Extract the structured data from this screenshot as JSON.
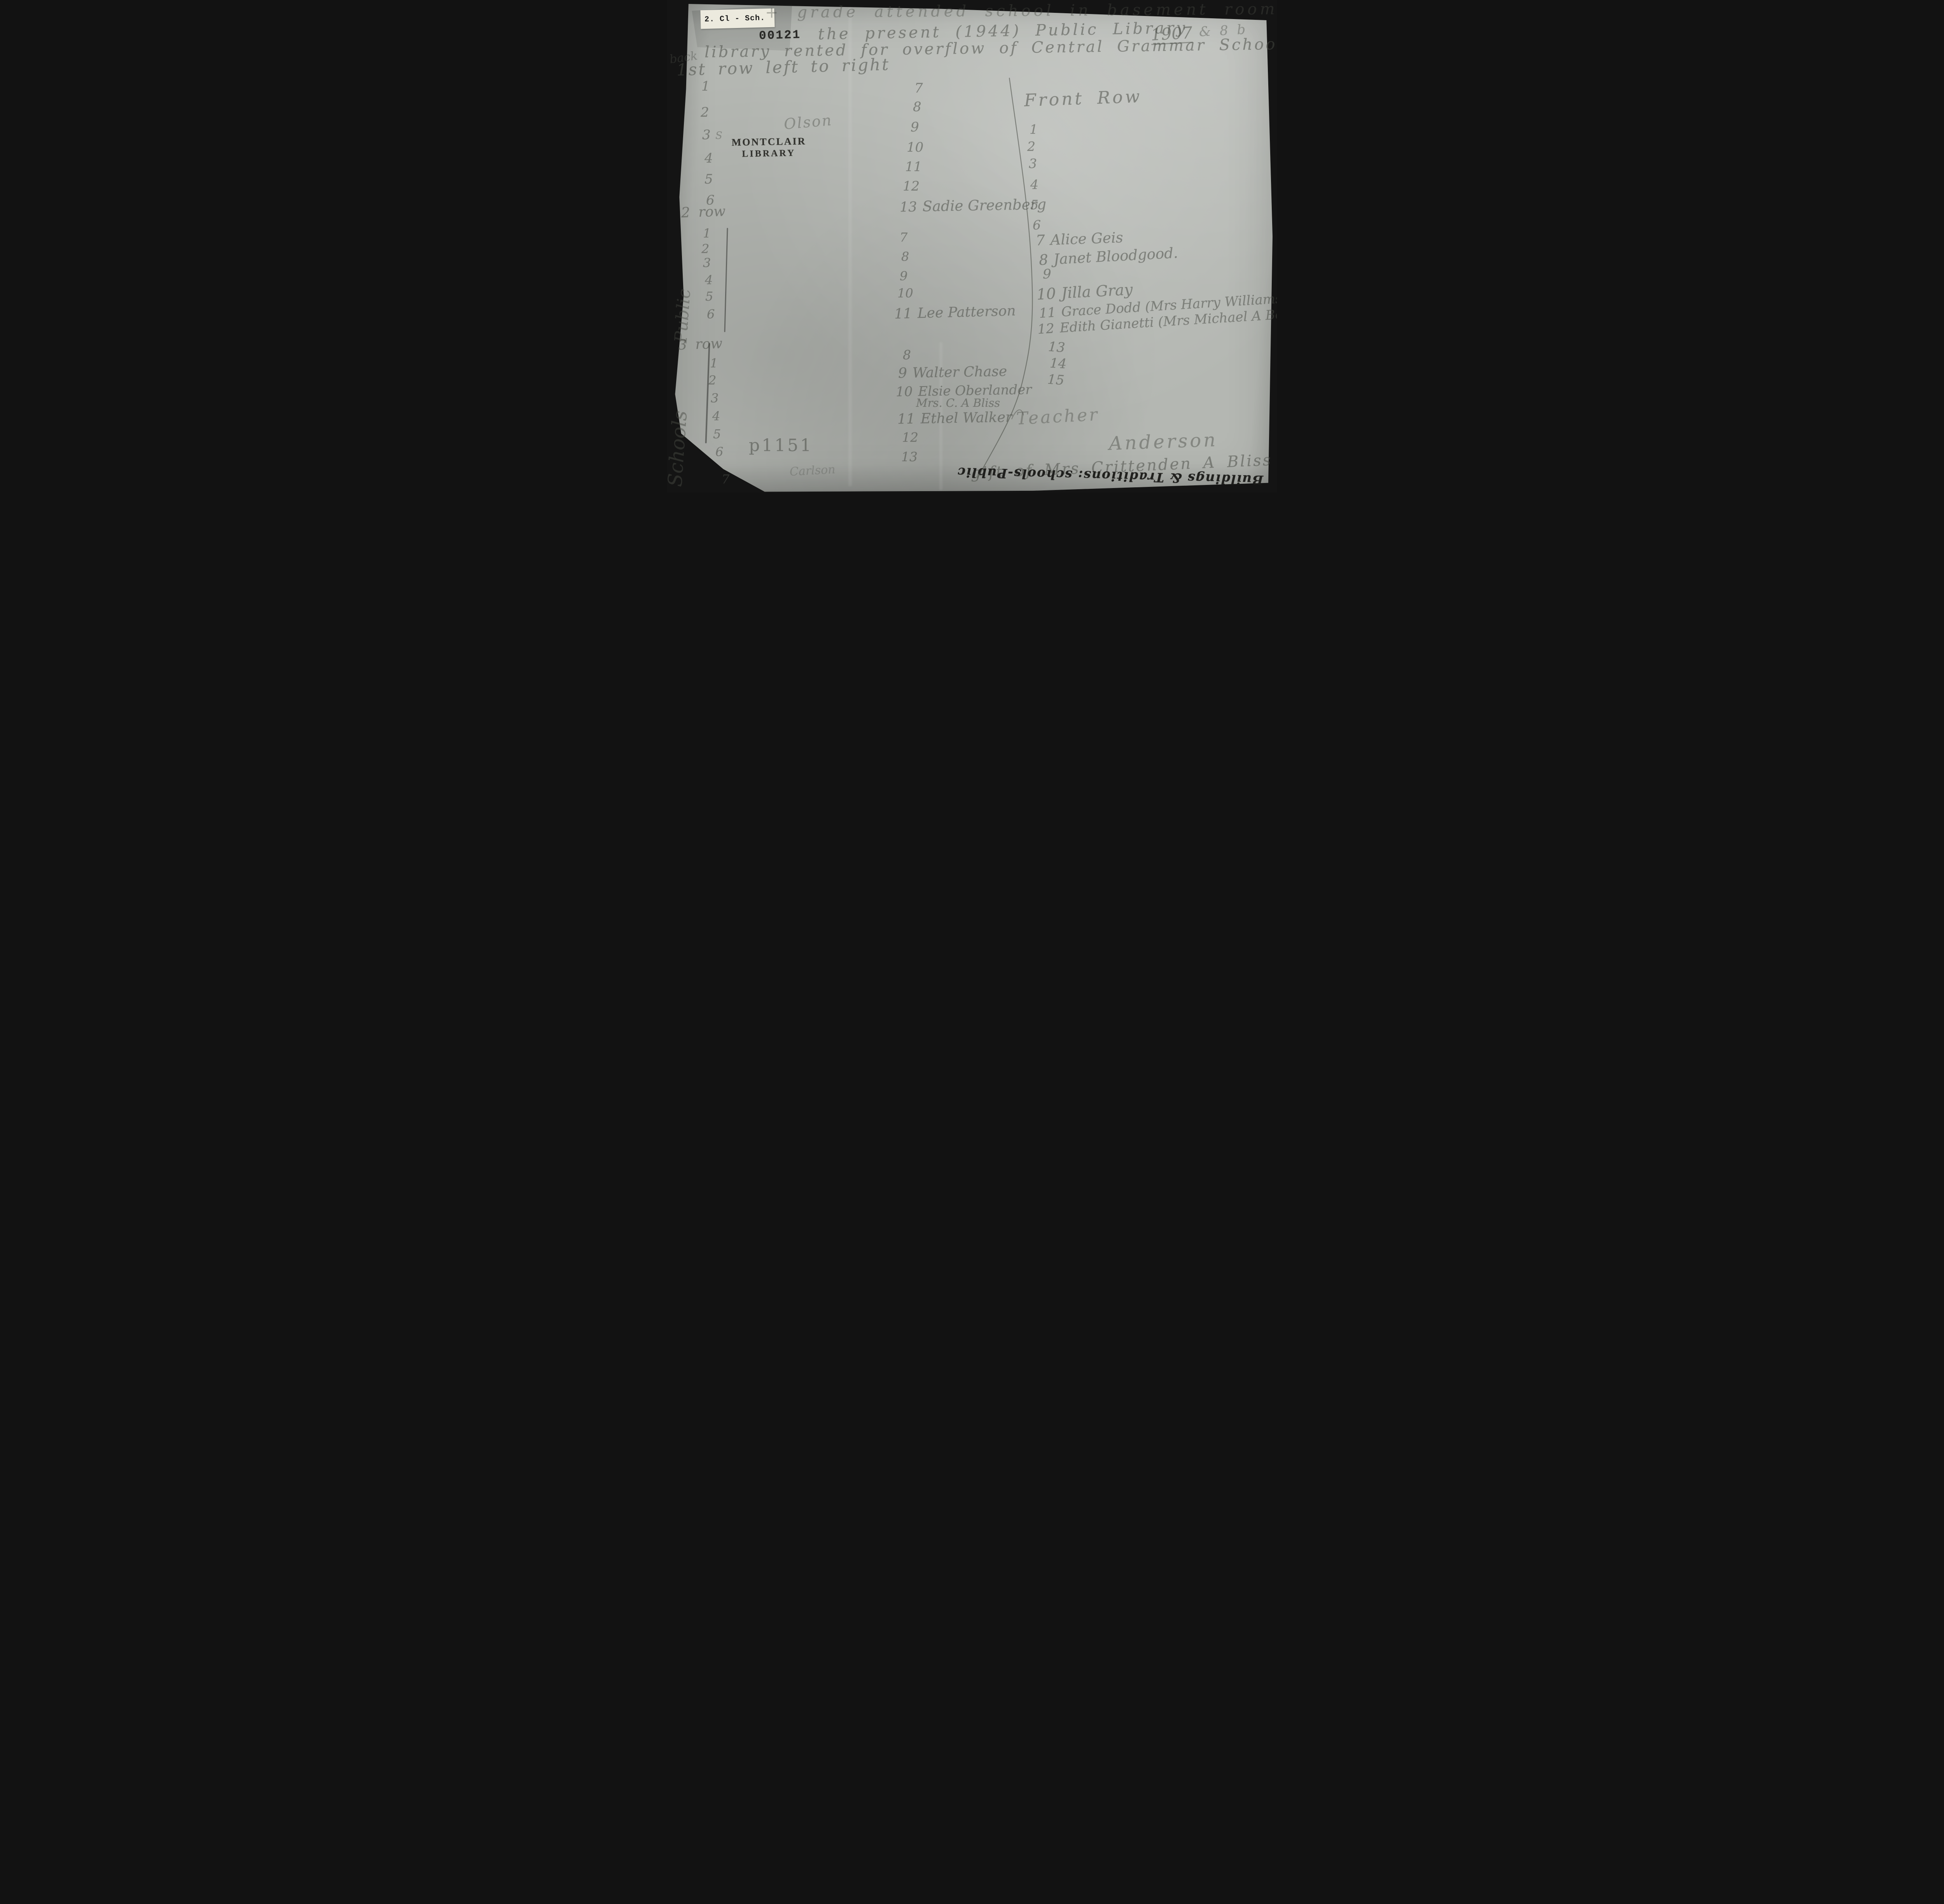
{
  "meta": {
    "background_color": "#141414",
    "paper_color": "#b4b7b2",
    "pencil_color": "#484a44",
    "ink_color": "#1a1a18"
  },
  "labels": {
    "classification_sticker": "2. Cl - Sch.",
    "accession_number": "00121",
    "library_stamp_line1": "MONTCLAIR",
    "library_stamp_line2": "LIBRARY",
    "call_number": "p1151"
  },
  "header": {
    "line1": "+ grade attended school in basement room",
    "line2": "the present (1944) Public Library",
    "line2_year": "1907",
    "line2_suffix": "& 8 b",
    "line3": "library rented for overflow of Central Grammar School",
    "back_note": "back",
    "direction_note": "1st row left to right"
  },
  "row1": {
    "left_numbers": [
      "1",
      "2",
      "3",
      "4",
      "5",
      "6"
    ],
    "flourish": "S",
    "side_name": "Olson",
    "middle_numbers": [
      "7",
      "8",
      "9",
      "10",
      "11",
      "12"
    ],
    "middle_last": {
      "number": "13",
      "name": "Sadie Greenberg"
    }
  },
  "front_row": {
    "heading": "Front Row",
    "numbers": [
      "1",
      "2",
      "3",
      "4",
      "5",
      "6"
    ],
    "entries": [
      {
        "number": "7",
        "name": "Alice Geis"
      },
      {
        "number": "8",
        "name": "Janet Bloodgood."
      },
      {
        "number": "9",
        "name": ""
      },
      {
        "number": "10",
        "name": "Jilla Gray"
      },
      {
        "number": "11",
        "name": "Grace Dodd (Mrs Harry Williams"
      },
      {
        "number": "12",
        "name": "Edith Gianetti (Mrs Michael A Bell."
      },
      {
        "number": "13",
        "name": ""
      },
      {
        "number": "14",
        "name": ""
      },
      {
        "number": "15",
        "name": ""
      }
    ]
  },
  "row2": {
    "heading": "2 row",
    "left_numbers": [
      "1",
      "2",
      "3",
      "4",
      "5",
      "6"
    ],
    "middle_numbers": [
      "7",
      "8",
      "9",
      "10"
    ],
    "middle_last": {
      "number": "11",
      "name": "Lee Patterson"
    }
  },
  "row3": {
    "heading": "3 row",
    "left_numbers": [
      "1",
      "2",
      "3",
      "4",
      "5",
      "6",
      "7"
    ],
    "entries": [
      {
        "number": "8",
        "name": "",
        "name2": ""
      },
      {
        "number": "9",
        "name": "Walter Chase",
        "name2": ""
      },
      {
        "number": "10",
        "name": "Elsie Oberlander",
        "name2": "Mrs. C. A Bliss"
      },
      {
        "number": "11",
        "name": "Ethel Walker",
        "name2": ""
      },
      {
        "number": "12",
        "name": "",
        "name2": ""
      },
      {
        "number": "13",
        "name": "",
        "name2": ""
      }
    ]
  },
  "annotations": {
    "teacher_label": "Teacher",
    "teacher_name": "Anderson",
    "gift_note": "gift of Mrs Crittenden A Bliss",
    "inverted_note": "Buildings & Traditions: schools-Public",
    "faint_name": "Carlson",
    "vertical_word_upper": "Public",
    "vertical_word_lower": "Schools"
  }
}
